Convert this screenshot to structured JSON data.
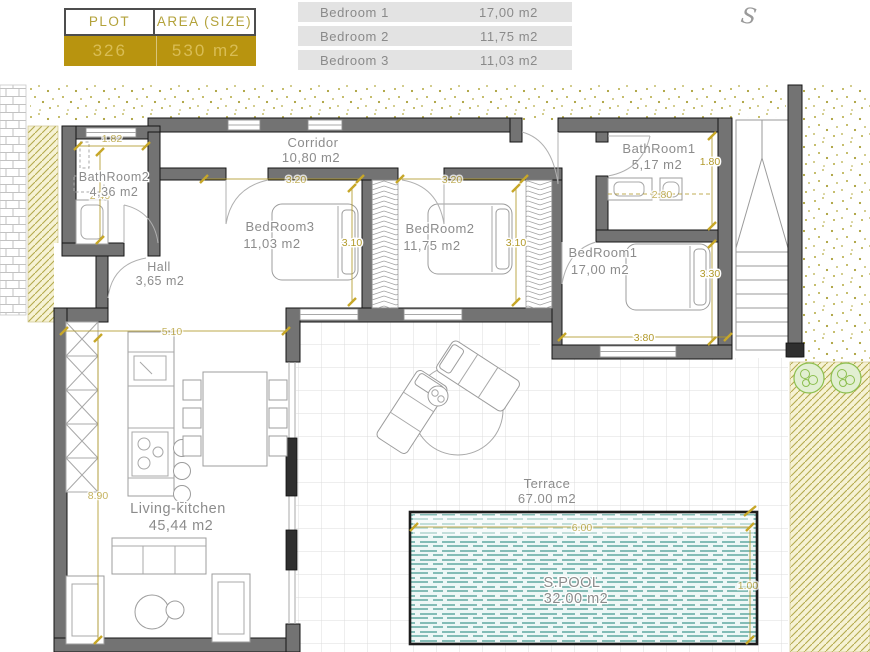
{
  "colors": {
    "accent_gold": "#b8940f",
    "dim_olive": "#b29a2b",
    "wall_gray": "#737373",
    "label_gray": "#8a8a8a",
    "water_teal": "#61a8a1",
    "table_row_bg": "#e3e3e3",
    "garden_olive": "#b5aa4e",
    "bush_green": "#8cbf4f"
  },
  "plot_table": {
    "headers": [
      "PLOT",
      "AREA (SIZE)"
    ],
    "values": [
      "326",
      "530 m2"
    ]
  },
  "area_table": {
    "rows": [
      {
        "label": "Bedroom 1",
        "value": "17,00 m2"
      },
      {
        "label": "Bedroom 2",
        "value": "11,75 m2"
      },
      {
        "label": "Bedroom 3",
        "value": "11,03 m2"
      }
    ]
  },
  "annotation": {
    "mark": "S"
  },
  "rooms": {
    "corridor": {
      "name": "Corridor",
      "area": "10,80 m2"
    },
    "bathroom2": {
      "name": "BathRoom2",
      "area": "4,36 m2"
    },
    "bathroom1": {
      "name": "BathRoom1",
      "area": "5,17 m2"
    },
    "bedroom3": {
      "name": "BedRoom3",
      "area": "11,03 m2"
    },
    "bedroom2": {
      "name": "BedRoom2",
      "area": "11,75 m2"
    },
    "bedroom1": {
      "name": "BedRoom1",
      "area": "17,00 m2"
    },
    "hall": {
      "name": "Hall",
      "area": "3,65 m2"
    },
    "living": {
      "name": "Living-kitchen",
      "area": "45,44 m2"
    },
    "terrace": {
      "name": "Terrace",
      "area": "67.00 m2"
    },
    "pool": {
      "name": "S.POOL",
      "area": "32.00 m2"
    }
  },
  "dimensions": {
    "bath2_width": "1.82",
    "bath2_depth": "2.40",
    "bed3_width": "3.20",
    "bed2_width": "3.20",
    "bed3_depth": "3.10",
    "bed2_depth": "3.10",
    "bath1_depth": "1.80",
    "bath1_width": "2.80",
    "bed1_depth": "3.30",
    "bed1_width": "3.80",
    "living_width": "5.10",
    "living_depth": "8.90",
    "pool_width": "6.00",
    "pool_depth": "1.00"
  }
}
